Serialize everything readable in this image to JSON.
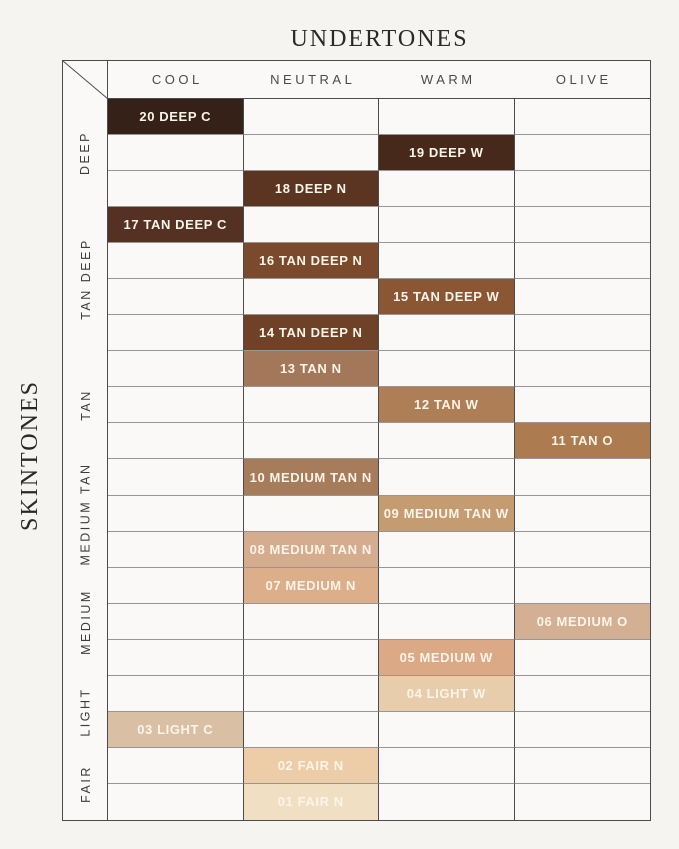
{
  "title": "UNDERTONES",
  "side_title": "SKINTONES",
  "colors": {
    "page_background": "#f6f4f1",
    "cell_background": "#faf9f7",
    "grid_line_dark": "#4c4c4c",
    "grid_line_light": "#989694",
    "swatch_text": "#fbf4e8",
    "header_text": "#4a4a4a",
    "title_text": "#2b2926"
  },
  "chart_data": {
    "type": "table",
    "title": "UNDERTONES",
    "col_axis_label": "UNDERTONES",
    "row_axis_label": "SKINTONES",
    "columns": [
      "COOL",
      "NEUTRAL",
      "WARM",
      "OLIVE"
    ],
    "row_groups": [
      {
        "label": "DEEP",
        "row_span": 3
      },
      {
        "label": "TAN DEEP",
        "row_span": 4
      },
      {
        "label": "TAN",
        "row_span": 3
      },
      {
        "label": "MEDIUM TAN",
        "row_span": 3
      },
      {
        "label": "MEDIUM",
        "row_span": 3
      },
      {
        "label": "LIGHT",
        "row_span": 2
      },
      {
        "label": "FAIR",
        "row_span": 2
      }
    ],
    "cells": [
      {
        "row": 1,
        "column": "COOL",
        "group": "DEEP",
        "label": "20 DEEP C",
        "color": "#362118"
      },
      {
        "row": 2,
        "column": "WARM",
        "group": "DEEP",
        "label": "19 DEEP W",
        "color": "#46291a"
      },
      {
        "row": 3,
        "column": "NEUTRAL",
        "group": "DEEP",
        "label": "18 DEEP N",
        "color": "#5c3522"
      },
      {
        "row": 4,
        "column": "COOL",
        "group": "TAN DEEP",
        "label": "17 TAN DEEP C",
        "color": "#543122"
      },
      {
        "row": 5,
        "column": "NEUTRAL",
        "group": "TAN DEEP",
        "label": "16 TAN DEEP N",
        "color": "#7b4a2c"
      },
      {
        "row": 6,
        "column": "WARM",
        "group": "TAN DEEP",
        "label": "15 TAN DEEP W",
        "color": "#8a5634"
      },
      {
        "row": 7,
        "column": "NEUTRAL",
        "group": "TAN DEEP",
        "label": "14 TAN DEEP N",
        "color": "#6f4228"
      },
      {
        "row": 8,
        "column": "NEUTRAL",
        "group": "TAN",
        "label": "13 TAN N",
        "color": "#a3775a"
      },
      {
        "row": 9,
        "column": "WARM",
        "group": "TAN",
        "label": "12 TAN W",
        "color": "#ae7f57"
      },
      {
        "row": 10,
        "column": "OLIVE",
        "group": "TAN",
        "label": "11 TAN O",
        "color": "#ad7b50"
      },
      {
        "row": 11,
        "column": "NEUTRAL",
        "group": "MEDIUM TAN",
        "label": "10 MEDIUM TAN N",
        "color": "#a67c5b"
      },
      {
        "row": 12,
        "column": "WARM",
        "group": "MEDIUM TAN",
        "label": "09 MEDIUM TAN W",
        "color": "#c59b72"
      },
      {
        "row": 13,
        "column": "NEUTRAL",
        "group": "MEDIUM TAN",
        "label": "08 MEDIUM TAN N",
        "color": "#d5ac8e"
      },
      {
        "row": 14,
        "column": "NEUTRAL",
        "group": "MEDIUM",
        "label": "07 MEDIUM N",
        "color": "#dcae89"
      },
      {
        "row": 15,
        "column": "OLIVE",
        "group": "MEDIUM",
        "label": "06 MEDIUM O",
        "color": "#d3b093"
      },
      {
        "row": 16,
        "column": "WARM",
        "group": "MEDIUM",
        "label": "05 MEDIUM W",
        "color": "#dca987"
      },
      {
        "row": 17,
        "column": "WARM",
        "group": "LIGHT",
        "label": "04 LIGHT W",
        "color": "#e8cdad"
      },
      {
        "row": 18,
        "column": "COOL",
        "group": "LIGHT",
        "label": "03 LIGHT C",
        "color": "#d9bfa4"
      },
      {
        "row": 19,
        "column": "NEUTRAL",
        "group": "FAIR",
        "label": "02 FAIR N",
        "color": "#eccda7"
      },
      {
        "row": 20,
        "column": "NEUTRAL",
        "group": "FAIR",
        "label": "01 FAIR N",
        "color": "#f0dfc3"
      }
    ]
  }
}
